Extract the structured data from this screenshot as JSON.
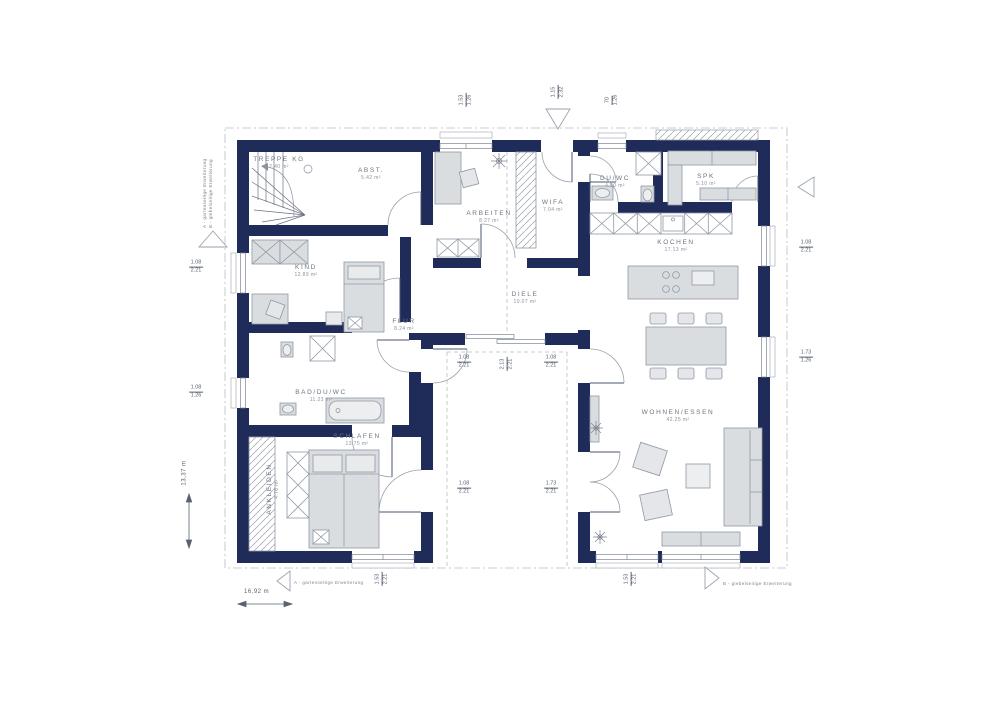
{
  "colors": {
    "wall": "#1f2c5a",
    "furniture_fill": "#dadde0",
    "furniture_stroke": "#9099a4",
    "label_gray": "#6d7580",
    "dash_gray": "#b8bdc3"
  },
  "rooms": [
    {
      "name": "TREPPE KG",
      "area": "2.40 m²"
    },
    {
      "name": "ABST.",
      "area": "5.42 m²"
    },
    {
      "name": "ARBEITEN",
      "area": "8.27 m²"
    },
    {
      "name": "WIFA",
      "area": "7.04 m²"
    },
    {
      "name": "DU/WC",
      "area": "4.50 m²"
    },
    {
      "name": "SPK",
      "area": "5.10 m²"
    },
    {
      "name": "KOCHEN",
      "area": "17.13 m²"
    },
    {
      "name": "KIND",
      "area": "12.89 m²"
    },
    {
      "name": "DIELE",
      "area": "10.07 m²"
    },
    {
      "name": "FLUR",
      "area": "8.24 m²"
    },
    {
      "name": "BAD/DU/WC",
      "area": "11.23 m²"
    },
    {
      "name": "SCHLAFEN",
      "area": "13.75 m²"
    },
    {
      "name": "ANKLEIDEN",
      "area": "4.76 m²"
    },
    {
      "name": "WOHNEN/ESSEN",
      "area": "42.25 m²"
    }
  ],
  "dims": [
    {
      "w": "1.53",
      "h": "1.26"
    },
    {
      "w": "1.15",
      "h": "2.32"
    },
    {
      "w": "70",
      "h": "1.26"
    },
    {
      "w": "1.08",
      "h": "2.21"
    },
    {
      "w": "1.73",
      "h": "1.26"
    },
    {
      "w": "1.08",
      "h": "2.21"
    },
    {
      "w": "1.08",
      "h": "1.26"
    },
    {
      "w": "1.08",
      "h": "2.21"
    },
    {
      "w": "2.13",
      "h": "2.21"
    },
    {
      "w": "1.08",
      "h": "2.21"
    },
    {
      "w": "1.08",
      "h": "2.21"
    },
    {
      "w": "1.73",
      "h": "2.21"
    },
    {
      "w": "1.53",
      "h": "2.21"
    },
    {
      "w": "1.53",
      "h": "2.21"
    }
  ],
  "annotations": {
    "bottom_left": "A - gartenseitige Erweiterung",
    "bottom_right": "B - giebelseitige Erweiterung",
    "side_line1": "A - gartenseitige Erweiterung",
    "side_line2": "B - giebelseitige Erweiterung"
  },
  "scale": {
    "width": "16,92 m",
    "height": "13,37 m"
  }
}
